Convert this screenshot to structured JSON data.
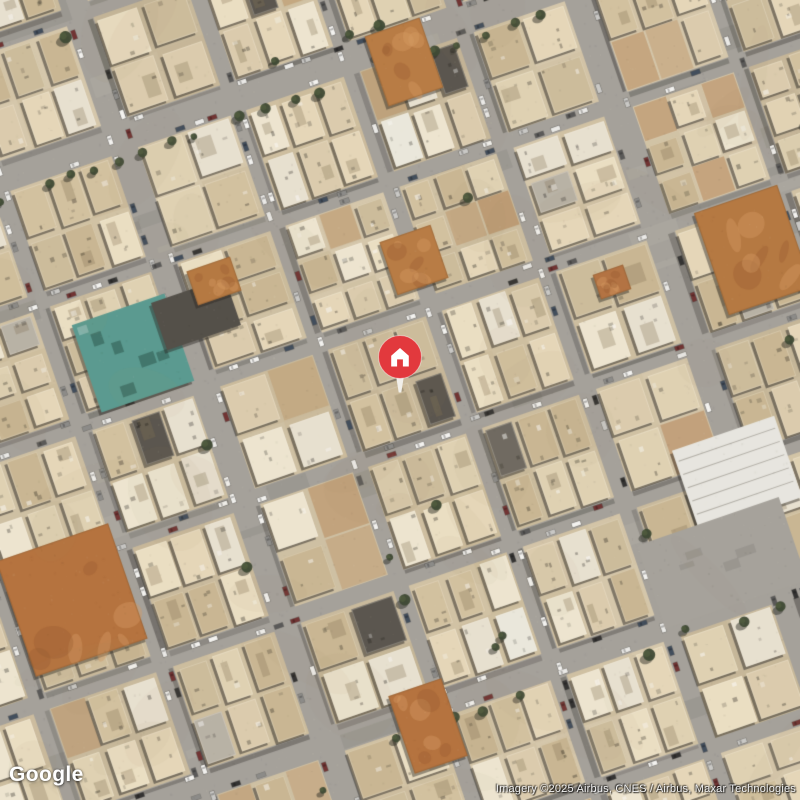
{
  "overlays": {
    "logo": "Google",
    "attribution": "Imagery ©2025 Airbus, CNES / Airbus, Maxar Technologies"
  },
  "marker": {
    "kind": "property-location-pin",
    "pin_color": "#e2393d",
    "pin_rim_color": "#f6d9d2",
    "tail_color": "#f1efe9",
    "icon": "home-icon",
    "icon_color": "#ffffff",
    "x": 400,
    "y": 357
  },
  "map": {
    "view": "satellite",
    "scene": "dense desert-city residential blocks with diagonally rotated street grid, beige rooftops, parked cars, scattered trees and dirt lots",
    "rotation_rad": -0.33,
    "palette": {
      "ground": [
        "#cfc1a4",
        "#d6c8ac",
        "#c9bb9e",
        "#d2c3a5"
      ],
      "road": "#a4a19b",
      "road_patch_dark": "rgba(70,68,63,0.10)",
      "building": [
        "#ece0c4",
        "#e6d8ba",
        "#dccdae",
        "#d3c2a0",
        "#efe7d2",
        "#e9e2d2",
        "#cdbd9c",
        "#c9b793",
        "#e0d3b4"
      ],
      "building_rare": [
        "#57534c",
        "#6b675f",
        "#b8b2a6",
        "#eceade"
      ],
      "shadow": "rgba(38,36,32,0.5)",
      "tree_dark": "rgba(58,70,48,0.95)",
      "tree_light": "rgba(80,95,62,0.6)",
      "tree_shadow": "rgba(28,30,24,0.45)",
      "dirt": [
        "#b5713c",
        "#bd7c45",
        "#aa6a38"
      ],
      "car": [
        "#f5f5f3",
        "#f5f5f3",
        "#ececea",
        "#2e2e2e",
        "#565656",
        "#8a8a88",
        "#c9c9c7",
        "#6e2f2f",
        "#3d4a5a"
      ]
    },
    "streets": {
      "vertical": [
        {
          "u": -560,
          "w": 14
        },
        {
          "u": -440,
          "w": 15
        },
        {
          "u": -310,
          "w": 16
        },
        {
          "u": -180,
          "w": 26
        },
        {
          "u": -60,
          "w": 14
        },
        {
          "u": 60,
          "w": 15
        },
        {
          "u": 180,
          "w": 16
        },
        {
          "u": 300,
          "w": 28
        },
        {
          "u": 430,
          "w": 14
        },
        {
          "u": 560,
          "w": 15
        },
        {
          "u": 690,
          "w": 14
        }
      ],
      "horizontal": [
        {
          "v": -600,
          "w": 14
        },
        {
          "v": -470,
          "w": 15
        },
        {
          "v": -340,
          "w": 30
        },
        {
          "v": -210,
          "w": 14
        },
        {
          "v": -80,
          "w": 16
        },
        {
          "v": 45,
          "w": 14
        },
        {
          "v": 170,
          "w": 15
        },
        {
          "v": 300,
          "w": 26
        },
        {
          "v": 430,
          "w": 14
        },
        {
          "v": 560,
          "w": 16
        },
        {
          "v": 690,
          "w": 14
        }
      ]
    }
  },
  "features": [
    {
      "name": "teal-roofed-building",
      "type": "building",
      "x": 133,
      "y": 353,
      "w": 98,
      "h": 92,
      "color": "#579a90"
    },
    {
      "name": "dark-roof-building",
      "type": "building",
      "x": 196,
      "y": 314,
      "w": 78,
      "h": 50,
      "color": "#504c46"
    },
    {
      "name": "dirt-lot",
      "type": "dirt",
      "x": 72,
      "y": 600,
      "w": 118,
      "h": 122,
      "color": "#b5713c"
    },
    {
      "name": "dirt-lot",
      "type": "dirt",
      "x": 753,
      "y": 250,
      "w": 88,
      "h": 108,
      "color": "#b5773f"
    },
    {
      "name": "dirt-lot",
      "type": "dirt",
      "x": 404,
      "y": 62,
      "w": 58,
      "h": 74,
      "color": "#b87a42"
    },
    {
      "name": "dirt-lot",
      "type": "dirt",
      "x": 414,
      "y": 260,
      "w": 54,
      "h": 56,
      "color": "#b87a42"
    },
    {
      "name": "dirt-lot",
      "type": "dirt",
      "x": 428,
      "y": 726,
      "w": 56,
      "h": 82,
      "color": "#b5713c"
    },
    {
      "name": "dirt-lot",
      "type": "dirt",
      "x": 214,
      "y": 281,
      "w": 46,
      "h": 36,
      "color": "#b5773f"
    },
    {
      "name": "dirt-lot",
      "type": "dirt",
      "x": 612,
      "y": 282,
      "w": 32,
      "h": 26,
      "color": "#b27140"
    },
    {
      "name": "event-hall-white-building",
      "type": "building",
      "x": 737,
      "y": 474,
      "w": 108,
      "h": 86,
      "color": "#e9e8e2"
    },
    {
      "name": "paved-lot",
      "type": "paved",
      "x": 722,
      "y": 563,
      "w": 150,
      "h": 88,
      "color": "#a5a29c"
    }
  ]
}
